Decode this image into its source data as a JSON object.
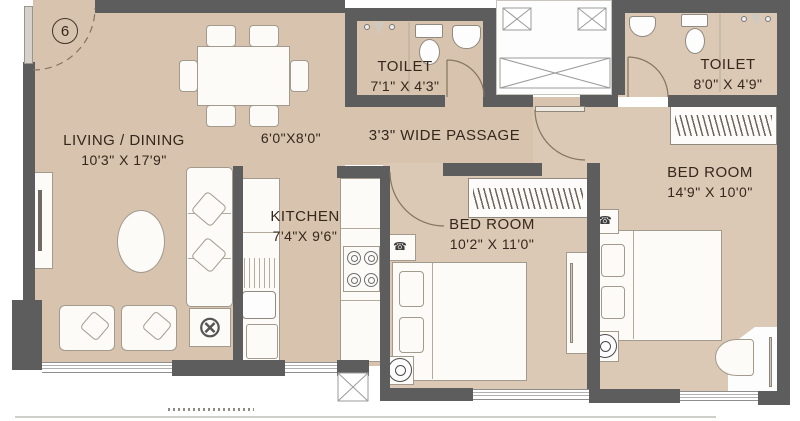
{
  "unit": {
    "number": "6"
  },
  "rooms": {
    "living": {
      "name": "LIVING / DINING",
      "dims": "10'3\" X 17'9\""
    },
    "dining": {
      "dims": "6'0\"X8'0\""
    },
    "kitchen": {
      "name": "KITCHEN",
      "dims": "7'4\"X 9'6\""
    },
    "toilet1": {
      "name": "TOILET",
      "dims": "7'1\" X 4'3\""
    },
    "toilet2": {
      "name": "TOILET",
      "dims": "8'0\" X 4'9\""
    },
    "passage": {
      "name": "3'3\"  WIDE PASSAGE"
    },
    "bedroom1": {
      "name": "BED ROOM",
      "dims": "10'2\" X 11'0\""
    },
    "bedroom2": {
      "name": "BED ROOM",
      "dims": "14'9\" X 10'0\""
    }
  },
  "icons": {
    "fan": "ceiling-fan-icon",
    "phone": "telephone-icon",
    "xtable": "circled-cross-table-icon"
  },
  "colors": {
    "floor": "#d7c3ae",
    "wall": "#5d5d5d",
    "text": "#35271b"
  }
}
